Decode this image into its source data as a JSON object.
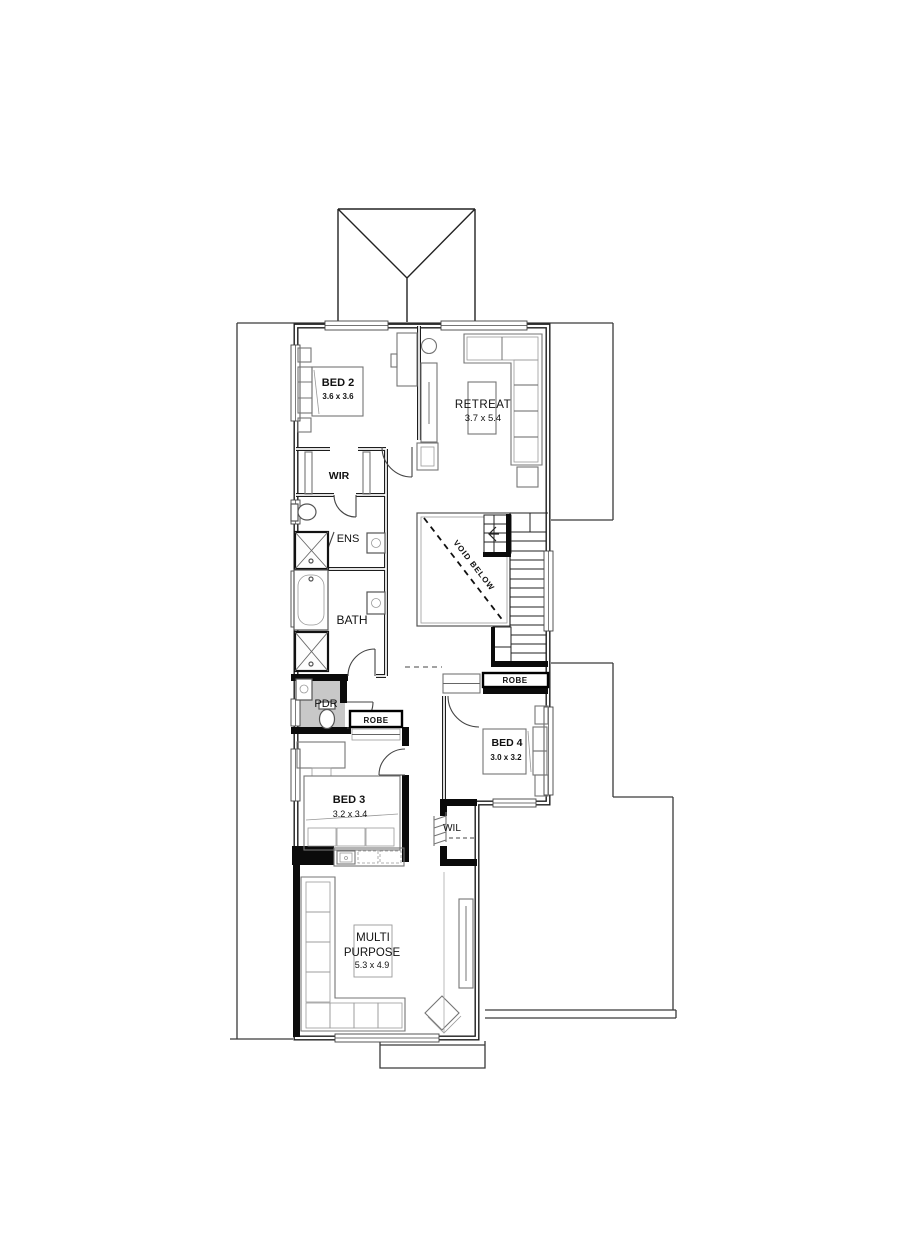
{
  "plan_type": "upper floor plan",
  "labels": {
    "bed2": {
      "name": "BED 2",
      "dims": "3.6 x 3.6"
    },
    "retreat": {
      "name": "RETREAT",
      "dims": "3.7 x 5.4"
    },
    "wir": {
      "name": "WIR"
    },
    "ens": {
      "name": "ENS"
    },
    "bath": {
      "name": "BATH"
    },
    "void_below": {
      "name": "VOID BELOW"
    },
    "robe_upper": {
      "name": "ROBE"
    },
    "pdr": {
      "name": "PDR"
    },
    "robe_lower": {
      "name": "ROBE"
    },
    "bed4": {
      "name": "BED 4",
      "dims": "3.0 x 3.2"
    },
    "bed3": {
      "name": "BED 3",
      "dims": "3.2 x 3.4"
    },
    "wil": {
      "name": "WIL"
    },
    "multi": {
      "line1": "MULTI",
      "line2": "PURPOSE",
      "dims": "5.3 x 4.9"
    }
  },
  "colors": {
    "wall": "#1d1d1d",
    "feature_wall": "#0b0b0b",
    "pdr_shade": "#c8c8c8",
    "background": "#ffffff"
  }
}
